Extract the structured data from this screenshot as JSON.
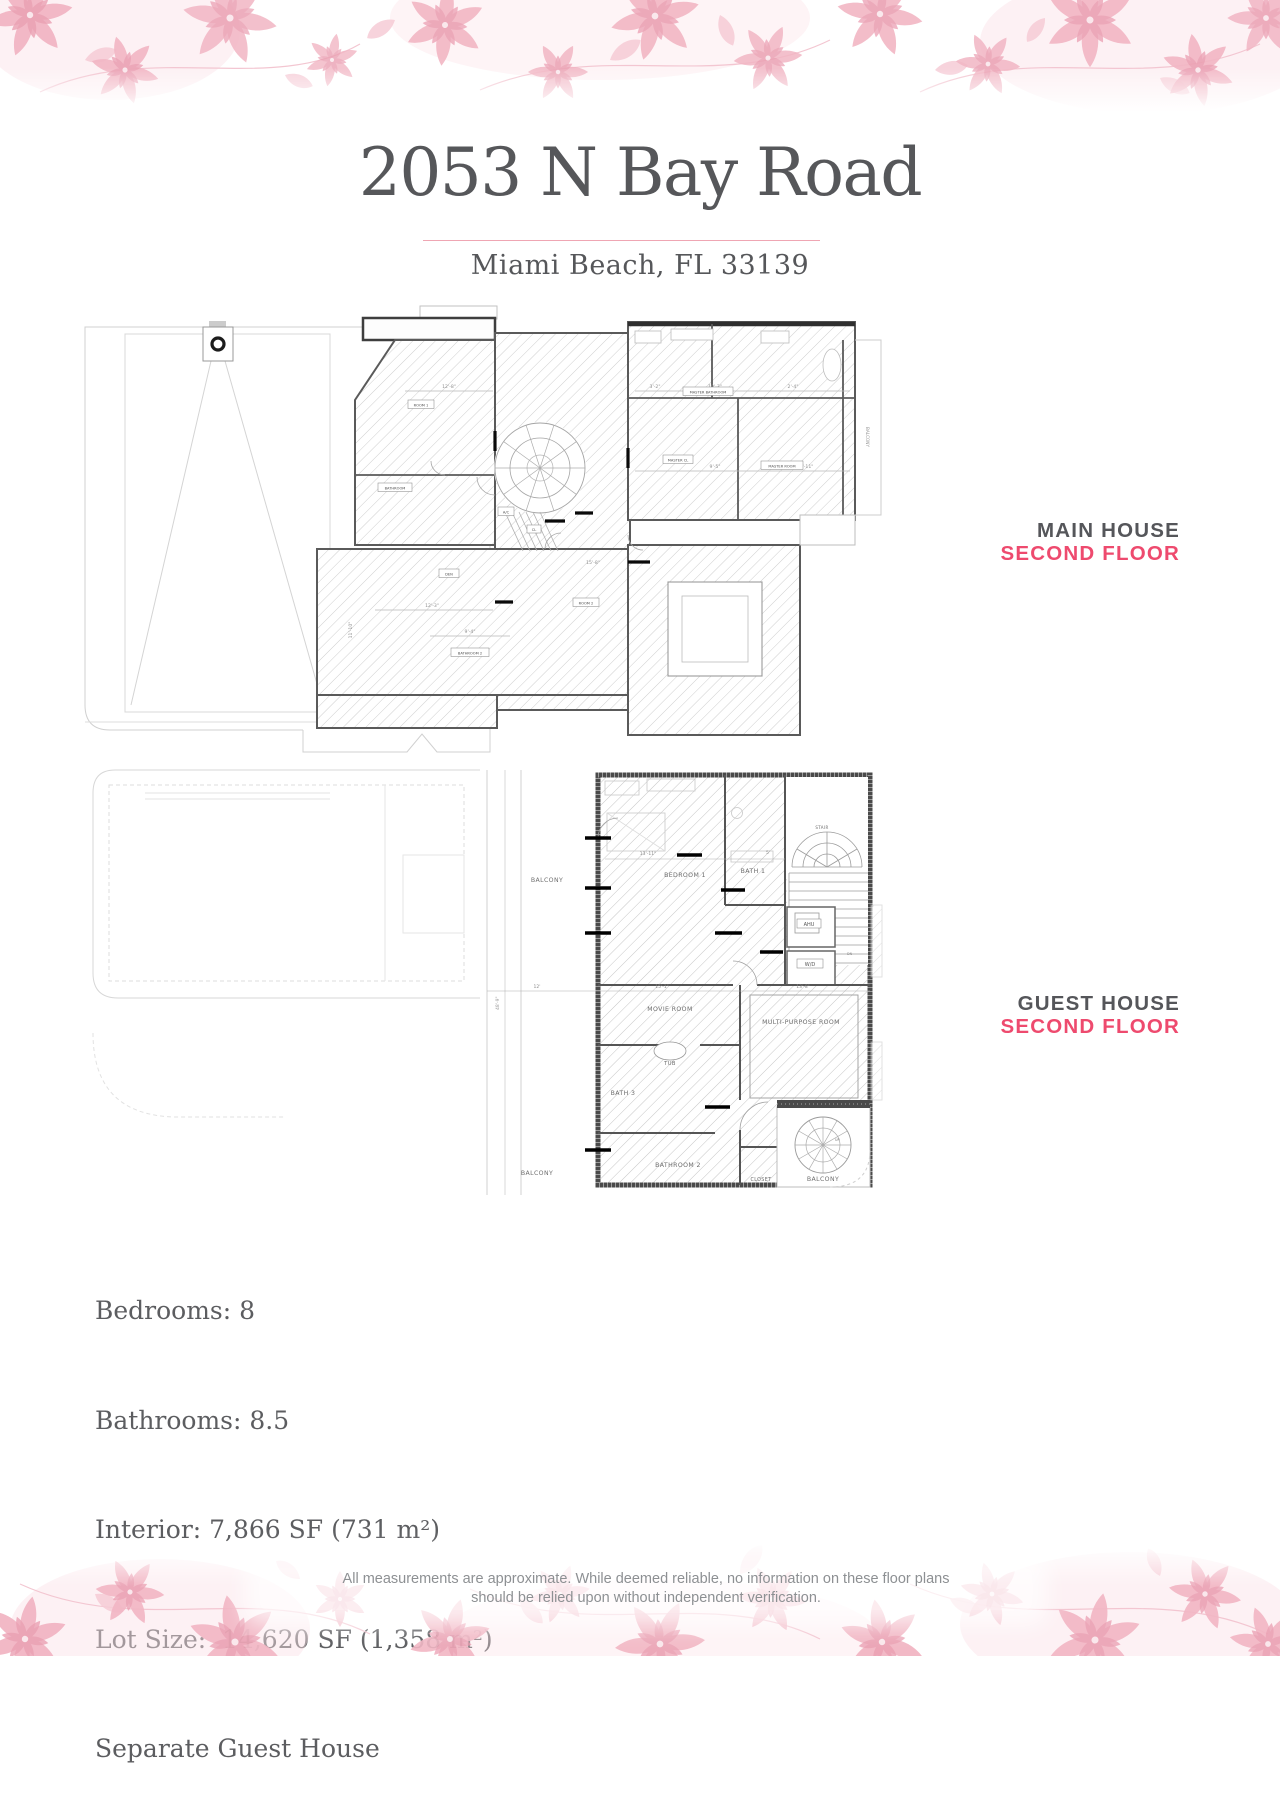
{
  "header": {
    "title": "2053 N Bay Road",
    "subtitle": "Miami Beach, FL 33139"
  },
  "section_labels": {
    "main_house": {
      "line1": "MAIN HOUSE",
      "line2": "SECOND FLOOR"
    },
    "guest_house": {
      "line1": "GUEST HOUSE",
      "line2": "SECOND FLOOR"
    }
  },
  "colors": {
    "accent_pink": "#ee4a6e",
    "heading_gray": "#55565a",
    "body_gray": "#5c5d60",
    "floral_light": "#f6ccd6",
    "floral_mid": "#f2b6c4",
    "floral_deep": "#ea9cb0"
  },
  "main_plan": {
    "room_labels": {
      "room1": "ROOM 1",
      "room2": "ROOM 2",
      "bathroom": "BATHROOM",
      "bathroom2": "BATHROOM 2",
      "ac": "A/C",
      "den": "DEN",
      "cl": "CL",
      "master_bathroom": "MASTER BATHROOM",
      "master_cl": "MASTER CL",
      "master_room": "MASTER ROOM",
      "balcony": "BALCONY"
    },
    "dims": {
      "d1": "12'-8\"",
      "d2": "3'-2\"",
      "d3": "10'-3\"",
      "d4": "2'-4\"",
      "d5": "9'-5\"",
      "d6": "12'-11\"",
      "d7": "15'-8\"",
      "d8": "12'-3\"",
      "d9": "9'-4\"",
      "d10": "11'-10\""
    }
  },
  "guest_plan": {
    "room_labels": {
      "balcony_top": "BALCONY",
      "bedroom1": "BEDROOM 1",
      "bath1": "BATH 1",
      "stair": "STAIR",
      "ahu": "AHU",
      "wd": "W/D",
      "dn": "DN",
      "movie": "MOVIE ROOM",
      "multi": "MULTI-PURPOSE ROOM",
      "tub": "TUB",
      "bath3": "BATH 3",
      "bathroom2": "BATHROOM 2",
      "closet": "CLOSET",
      "balcony_bl": "BALCONY",
      "balcony_br": "BALCONY",
      "up": "UP"
    },
    "dims": {
      "d1": "13'-11\"",
      "d2": "5'",
      "d3": "12'",
      "d4": "15'-1\"",
      "d5": "13'-8\"",
      "d6": "48'-9\""
    }
  },
  "details": {
    "line1": "Bedrooms: 8",
    "line2": "Bathrooms: 8.5",
    "line3": "Interior: 7,866 SF (731 m²)",
    "line4": "Lot Size:  14,620 SF (1,358 m²)",
    "line5": "Separate Guest House"
  },
  "disclaimer": {
    "line1": "All measurements are approximate. While deemed reliable, no information on these floor plans",
    "line2": "should be relied upon without independent verification."
  }
}
